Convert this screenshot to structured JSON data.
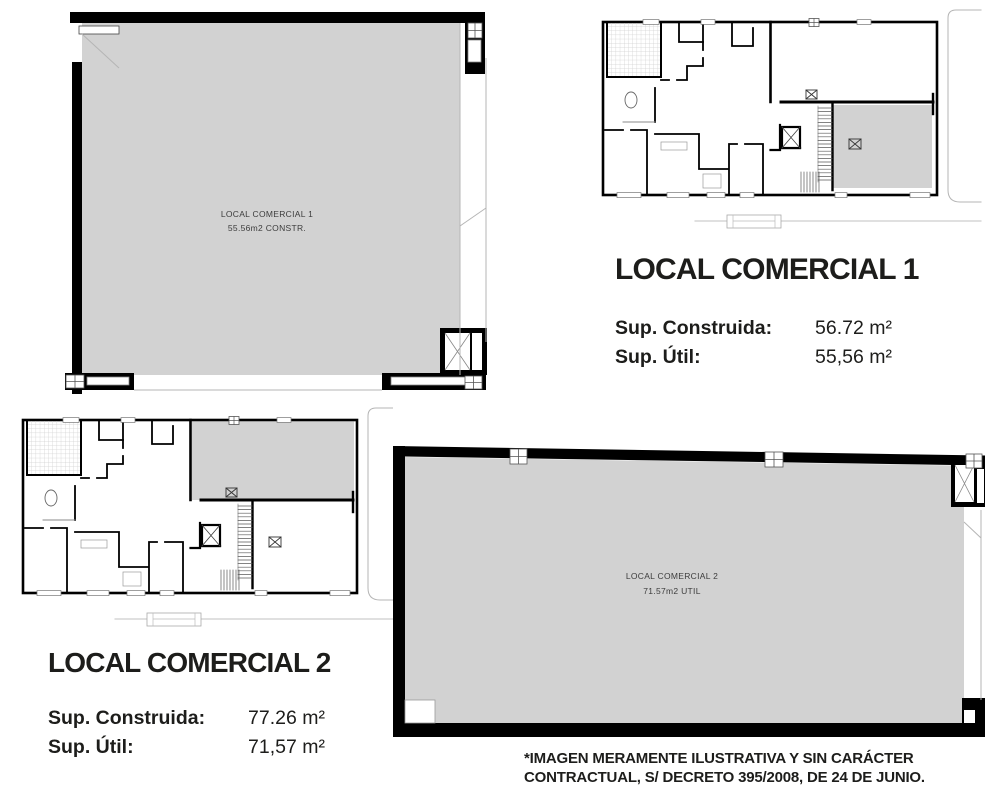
{
  "plans": {
    "large1": {
      "line1": "LOCAL COMERCIAL 1",
      "line2": "55.56m2 CONSTR."
    },
    "large2": {
      "line1": "LOCAL COMERCIAL 2",
      "line2": "71.57m2 UTIL"
    }
  },
  "sections": [
    {
      "title": "LOCAL COMERCIAL 1",
      "rows": [
        {
          "label": "Sup. Construida:",
          "value": "56.72 m²"
        },
        {
          "label": "Sup. Útil:",
          "value": "55,56 m²"
        }
      ]
    },
    {
      "title": "LOCAL COMERCIAL 2",
      "rows": [
        {
          "label": "Sup. Construida:",
          "value": "77.26 m²"
        },
        {
          "label": "Sup. Útil:",
          "value": "71,57 m²"
        }
      ]
    }
  ],
  "disclaimer": {
    "line1": "*IMAGEN MERAMENTE ILUSTRATIVA Y SIN CARÁCTER",
    "line2": "CONTRACTUAL, S/ DECRETO 395/2008, DE 24 DE JUNIO."
  },
  "colors": {
    "unit_fill": "#d2d2d2",
    "wall": "#000000",
    "thin_line": "#a6a6a6",
    "text": "#1d1d1b"
  }
}
